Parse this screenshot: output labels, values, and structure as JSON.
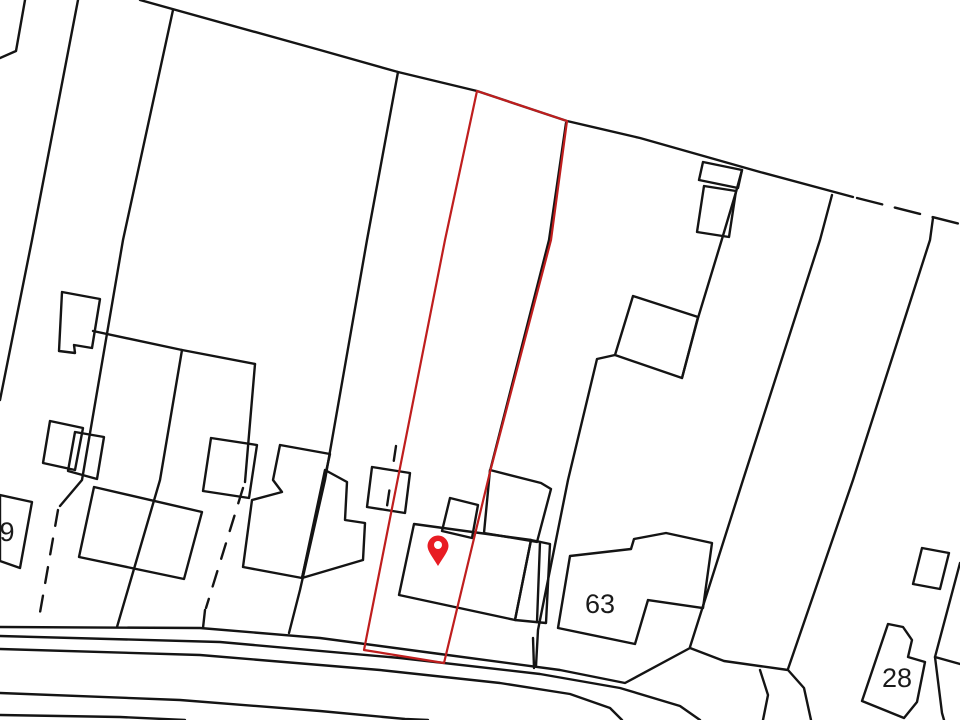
{
  "map": {
    "description": "Property site plan with highlighted plot outline and location pin",
    "canvas": {
      "width": 960,
      "height": 720,
      "background": "#ffffff"
    },
    "style": {
      "line_color": "#141414",
      "line_width": 2.4,
      "plot_outline_color": "#bf1e1e",
      "plot_outline_width": 2.2,
      "pin_color": "#e81c23",
      "label_color": "#1a1a1a"
    },
    "labels": [
      {
        "text": "9",
        "x": 7,
        "y": 541,
        "size": 27
      },
      {
        "text": "63",
        "x": 600,
        "y": 613,
        "size": 27
      },
      {
        "text": "28",
        "x": 897,
        "y": 687,
        "size": 27
      }
    ],
    "pin": {
      "x": 438,
      "y": 546,
      "tip_y": 566,
      "radius": 10.5,
      "hole_radius": 4
    },
    "plot_outline": [
      [
        477,
        91
      ],
      [
        567,
        121
      ],
      [
        551,
        240
      ],
      [
        490,
        472
      ],
      [
        444,
        663
      ],
      [
        364,
        650
      ],
      [
        445,
        240
      ]
    ],
    "solid_lines": [
      [
        [
          25,
          0
        ],
        [
          16,
          51
        ],
        [
          0,
          58
        ]
      ],
      [
        [
          78,
          0
        ],
        [
          32,
          240
        ],
        [
          0,
          400
        ]
      ],
      [
        [
          140,
          0
        ],
        [
          320,
          50
        ],
        [
          398,
          72
        ],
        [
          477,
          91
        ],
        [
          567,
          121
        ],
        [
          640,
          138
        ],
        [
          760,
          172
        ],
        [
          853,
          197
        ]
      ],
      [
        [
          173,
          10
        ],
        [
          123,
          240
        ],
        [
          82,
          480
        ],
        [
          60,
          506
        ]
      ],
      [
        [
          398,
          72
        ],
        [
          367,
          240
        ],
        [
          325,
          480
        ],
        [
          300,
          590
        ],
        [
          289,
          633
        ]
      ],
      [
        [
          566,
          123
        ],
        [
          549,
          240
        ],
        [
          490,
          471
        ]
      ],
      [
        [
          742,
          170
        ],
        [
          736,
          192
        ],
        [
          722,
          239
        ],
        [
          698,
          318
        ],
        [
          682,
          378
        ]
      ],
      [
        [
          615,
          355
        ],
        [
          597,
          359
        ],
        [
          568,
          480
        ],
        [
          538,
          630
        ],
        [
          536,
          666
        ]
      ],
      [
        [
          832,
          195
        ],
        [
          820,
          240
        ],
        [
          743,
          480
        ],
        [
          690,
          647
        ]
      ],
      [
        [
          933,
          218
        ],
        [
          930,
          240
        ],
        [
          853,
          480
        ],
        [
          788,
          669
        ]
      ],
      [
        [
          960,
          563
        ],
        [
          935,
          657
        ],
        [
          942,
          713
        ],
        [
          944,
          720
        ]
      ],
      [
        [
          935,
          657
        ],
        [
          960,
          664
        ]
      ],
      [
        [
          93,
          331
        ],
        [
          182,
          350
        ],
        [
          255,
          364
        ]
      ],
      [
        [
          182,
          350
        ],
        [
          160,
          480
        ],
        [
          117,
          627
        ]
      ],
      [
        [
          255,
          364
        ],
        [
          245,
          482
        ]
      ],
      [
        [
          205,
          610
        ],
        [
          203,
          628
        ]
      ],
      [
        [
          533,
          638
        ],
        [
          534,
          668
        ]
      ],
      [
        [
          540,
          542
        ],
        [
          537,
          622
        ]
      ],
      [
        [
          0,
          627
        ],
        [
          200,
          628
        ],
        [
          320,
          638
        ],
        [
          440,
          654
        ],
        [
          560,
          670
        ],
        [
          625,
          683
        ],
        [
          690,
          648
        ],
        [
          724,
          661
        ],
        [
          788,
          670
        ],
        [
          804,
          688
        ],
        [
          811,
          720
        ]
      ],
      [
        [
          0,
          636
        ],
        [
          220,
          642
        ],
        [
          400,
          658
        ],
        [
          540,
          674
        ],
        [
          620,
          688
        ],
        [
          680,
          706
        ],
        [
          700,
          720
        ]
      ],
      [
        [
          0,
          649
        ],
        [
          200,
          655
        ],
        [
          380,
          670
        ],
        [
          500,
          683
        ],
        [
          570,
          694
        ],
        [
          610,
          708
        ],
        [
          622,
          720
        ]
      ],
      [
        [
          0,
          693
        ],
        [
          180,
          700
        ],
        [
          320,
          711
        ],
        [
          405,
          719
        ],
        [
          428,
          720
        ]
      ],
      [
        [
          0,
          715
        ],
        [
          120,
          717
        ],
        [
          185,
          720
        ]
      ],
      [
        [
          760,
          670
        ],
        [
          768,
          695
        ],
        [
          763,
          720
        ]
      ]
    ],
    "polygons": [
      [
        [
          0,
          495
        ],
        [
          32,
          502
        ],
        [
          20,
          568
        ],
        [
          0,
          561
        ]
      ],
      [
        [
          62,
          292
        ],
        [
          100,
          299
        ],
        [
          92,
          348
        ],
        [
          74,
          345
        ],
        [
          75,
          353
        ],
        [
          59,
          351
        ]
      ],
      [
        [
          704,
          186
        ],
        [
          736,
          191
        ],
        [
          729,
          237
        ],
        [
          697,
          232
        ]
      ],
      [
        [
          703,
          162
        ],
        [
          742,
          170
        ],
        [
          738,
          188
        ],
        [
          699,
          180
        ]
      ],
      [
        [
          633,
          296
        ],
        [
          698,
          317
        ],
        [
          682,
          378
        ],
        [
          615,
          355
        ]
      ],
      [
        [
          94,
          487
        ],
        [
          202,
          512
        ],
        [
          184,
          579
        ],
        [
          79,
          557
        ]
      ],
      [
        [
          50,
          421
        ],
        [
          83,
          428
        ],
        [
          75,
          470
        ],
        [
          43,
          463
        ]
      ],
      [
        [
          75,
          432
        ],
        [
          104,
          437
        ],
        [
          97,
          479
        ],
        [
          68,
          471
        ]
      ],
      [
        [
          211,
          438
        ],
        [
          257,
          445
        ],
        [
          249,
          498
        ],
        [
          203,
          491
        ]
      ],
      [
        [
          280,
          445
        ],
        [
          330,
          454
        ],
        [
          302,
          578
        ],
        [
          243,
          567
        ],
        [
          252,
          500
        ],
        [
          282,
          492
        ],
        [
          273,
          480
        ]
      ],
      [
        [
          325,
          470
        ],
        [
          347,
          482
        ],
        [
          345,
          520
        ],
        [
          365,
          523
        ],
        [
          363,
          560
        ],
        [
          302,
          578
        ]
      ],
      [
        [
          372,
          467
        ],
        [
          410,
          473
        ],
        [
          405,
          513
        ],
        [
          367,
          507
        ]
      ],
      [
        [
          450,
          498
        ],
        [
          478,
          505
        ],
        [
          472,
          538
        ],
        [
          442,
          531
        ]
      ],
      [
        [
          414,
          524
        ],
        [
          531,
          540
        ],
        [
          515,
          620
        ],
        [
          399,
          595
        ]
      ],
      [
        [
          490,
          470
        ],
        [
          541,
          483
        ],
        [
          551,
          489
        ],
        [
          537,
          542
        ],
        [
          484,
          533
        ]
      ],
      [
        [
          531,
          540
        ],
        [
          550,
          544
        ],
        [
          546,
          623
        ],
        [
          515,
          620
        ]
      ],
      [
        [
          570,
          556
        ],
        [
          631,
          549
        ],
        [
          634,
          539
        ],
        [
          666,
          533
        ],
        [
          712,
          543
        ],
        [
          703,
          608
        ],
        [
          648,
          600
        ],
        [
          635,
          644
        ],
        [
          558,
          628
        ]
      ],
      [
        [
          922,
          548
        ],
        [
          949,
          553
        ],
        [
          940,
          589
        ],
        [
          913,
          584
        ]
      ],
      [
        [
          888,
          624
        ],
        [
          903,
          627
        ],
        [
          912,
          640
        ],
        [
          908,
          657
        ],
        [
          925,
          662
        ],
        [
          917,
          702
        ],
        [
          904,
          718
        ],
        [
          862,
          701
        ]
      ]
    ],
    "dashed_lines": [
      {
        "points": [
          [
            58,
            510
          ],
          [
            38,
            624
          ]
        ],
        "dash": "16,13"
      },
      {
        "points": [
          [
            243,
            488
          ],
          [
            206,
            608
          ]
        ],
        "dash": "16,13"
      },
      {
        "points": [
          [
            857,
            198
          ],
          [
            960,
            224
          ]
        ],
        "dash": "26,13"
      }
    ],
    "overlay_dashes": [
      {
        "points": [
          [
            396,
            446
          ],
          [
            383,
            533
          ]
        ],
        "dash": "15,30"
      }
    ]
  }
}
